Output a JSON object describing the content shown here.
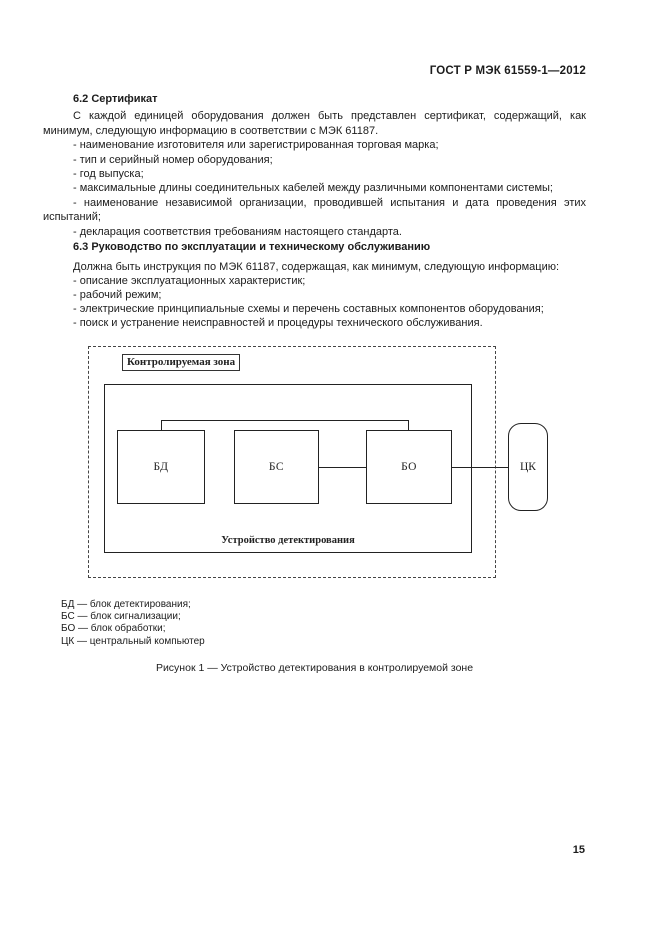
{
  "header": {
    "designation": "ГОСТ Р МЭК 61559-1—2012"
  },
  "section_62": {
    "heading": "6.2 Сертификат",
    "paragraph": "С каждой единицей оборудования должен быть представлен сертификат, содержащий, как минимум, следующую информацию в соответствии с МЭК 61187.",
    "items": [
      "- наименование изготовителя или зарегистрированная торговая марка;",
      "- тип и серийный номер оборудования;",
      "- год выпуска;",
      "- максимальные длины соединительных кабелей между различными компонентами системы;",
      "- наименование независимой организации, проводившей испытания и дата проведения этих испытаний;",
      "- декларация соответствия требованиям настоящего стандарта."
    ]
  },
  "section_63": {
    "heading": "6.3 Руководство по эксплуатации и техническому обслуживанию",
    "paragraph": "Должна быть инструкция по МЭК 61187, содержащая, как минимум, следующую информацию:",
    "items": [
      "- описание эксплуатационных характеристик;",
      "- рабочий режим;",
      "- электрические принципиальные схемы и перечень составных компонентов оборудования;",
      "- поиск и устранение неисправностей и процедуры технического обслуживания."
    ]
  },
  "figure": {
    "zone_label": "Контролируемая зона",
    "device_label": "Устройство детектирования",
    "blocks": {
      "bd": "БД",
      "bs": "БС",
      "bo": "БО",
      "ck": "ЦК"
    },
    "legend": [
      "БД — блок детектирования;",
      "БС — блок сигнализации;",
      "БО — блок обработки;",
      "ЦК — центральный компьютер"
    ],
    "caption": "Рисунок 1 — Устройство детектирования в контролируемой зоне"
  },
  "footer": {
    "page_number": "15"
  }
}
